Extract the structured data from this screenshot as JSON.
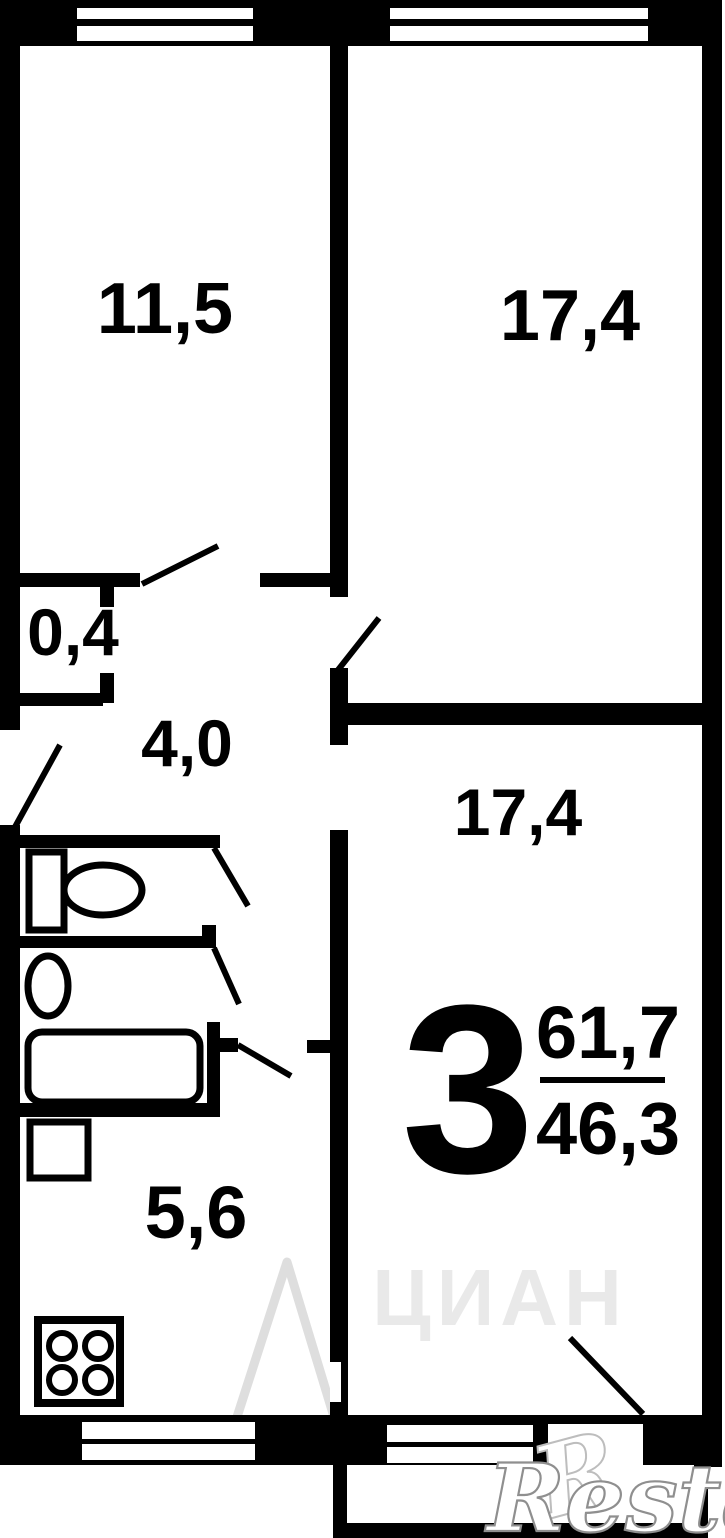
{
  "plan": {
    "type": "apartment-floor-plan",
    "rooms": {
      "room_top_left": {
        "area_label": "11,5"
      },
      "room_top_right": {
        "area_label": "17,4"
      },
      "closet": {
        "area_label": "0,4"
      },
      "hallway": {
        "area_label": "4,0"
      },
      "room_bottom_right": {
        "area_label": "17,4"
      },
      "kitchen": {
        "area_label": "5,6"
      }
    },
    "summary": {
      "rooms_count": "3",
      "total_area": "61,7",
      "living_area": "46,3"
    },
    "fixtures": [
      "window",
      "window",
      "toilet",
      "sink",
      "bathtub",
      "fridge",
      "stove",
      "window",
      "window",
      "balcony",
      "door-swing"
    ],
    "watermarks": {
      "cian": "ЦИАН",
      "restate": "Restate",
      "restate_initial": "R"
    }
  },
  "colors": {
    "wall": "#000000",
    "background": "#ffffff",
    "watermark_light": "#e9e9e9",
    "watermark_peak": "#dedede",
    "restate_outline": "#8f8f8f"
  }
}
